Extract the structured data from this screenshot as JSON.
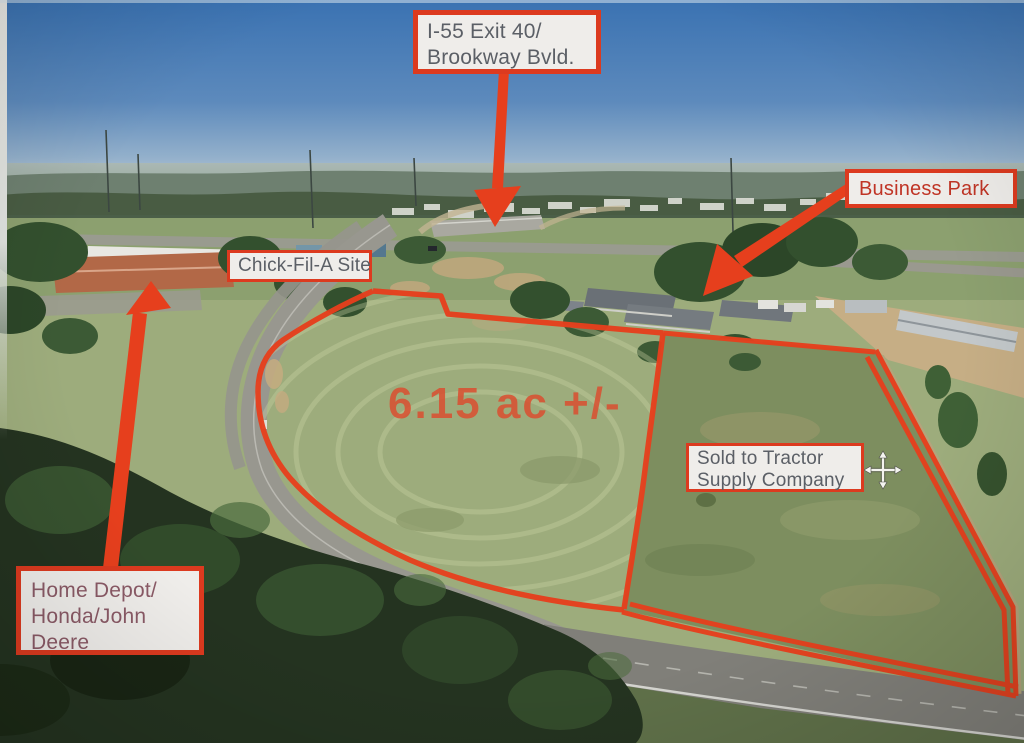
{
  "annotations": {
    "accent_color": "#dc3a1f",
    "label_bg_color": "#efedea",
    "label_text_color": "#5b5f66",
    "i55": {
      "line1": "I-55 Exit 40/",
      "line2": "Brookway Bvld."
    },
    "business_park": {
      "text": "Business Park",
      "text_color": "#c03425"
    },
    "chick_fil_a": {
      "text": "Chick-Fil-A Site"
    },
    "sold": {
      "line1": "Sold to Tractor",
      "line2": "Supply Company"
    },
    "home_depot": {
      "line1": "Home Depot/",
      "line2": "Honda/John",
      "line3": "Deere"
    },
    "acreage": {
      "text": "6.15 ac +/-",
      "text_color": "#dd4b2d"
    }
  },
  "cursor": {
    "type": "move-crosshair"
  }
}
